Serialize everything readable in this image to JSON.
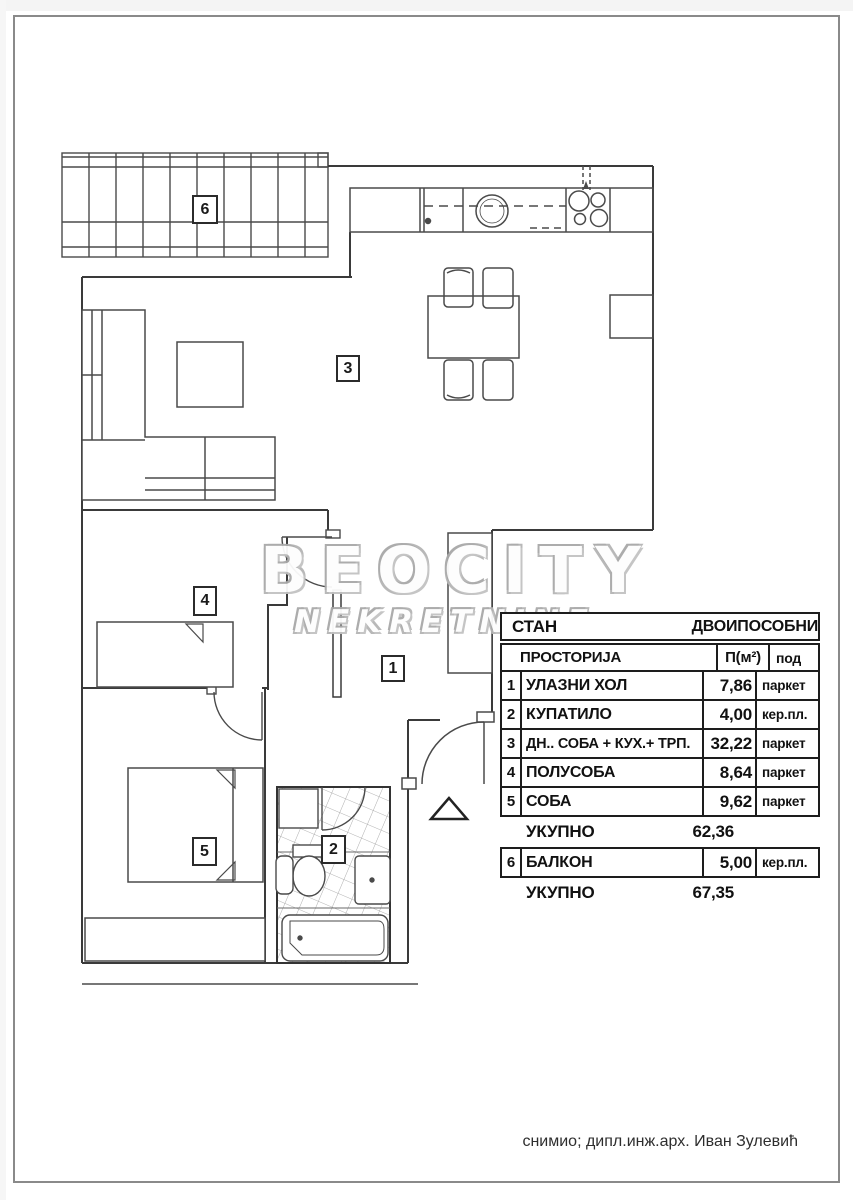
{
  "watermark": {
    "brand": "BEOCITY",
    "subtitle": "NEKRETNINE"
  },
  "plan_labels": {
    "hall": "1",
    "bathroom": "2",
    "living": "3",
    "half_room": "4",
    "room": "5",
    "balcony": "6"
  },
  "table": {
    "title_left": "СТАН",
    "title_right": "ДВОИПОСОБНИ",
    "col_room": "ПРОСТОРИЈА",
    "col_area": "П(м²)",
    "col_floor": "под",
    "rows": [
      {
        "num": "1",
        "name": "УЛАЗНИ ХОЛ",
        "area": "7,86",
        "floor": "паркет"
      },
      {
        "num": "2",
        "name": "КУПАТИЛО",
        "area": "4,00",
        "floor": "кер.пл."
      },
      {
        "num": "3",
        "name": "ДН.. СОБА + КУХ.+ ТРП.",
        "area": "32,22",
        "floor": "паркет"
      },
      {
        "num": "4",
        "name": "ПОЛУСОБА",
        "area": "8,64",
        "floor": "паркет"
      },
      {
        "num": "5",
        "name": "СОБА",
        "area": "9,62",
        "floor": "паркет"
      }
    ],
    "subtotal_label": "УКУПНО",
    "subtotal_value": "62,36",
    "balcony_row": {
      "num": "6",
      "name": "БАЛКОН",
      "area": "5,00",
      "floor": "кер.пл."
    },
    "total_label": "УКУПНО",
    "total_value": "67,35"
  },
  "footer": {
    "credit": "снимио;  дипл.инж.арх. Иван Зулевић"
  },
  "colors": {
    "plan_line": "#4a4a4a",
    "wall": "#3a3a3a",
    "table_border": "#1d1d1d",
    "watermark": "#b5b5b5"
  }
}
